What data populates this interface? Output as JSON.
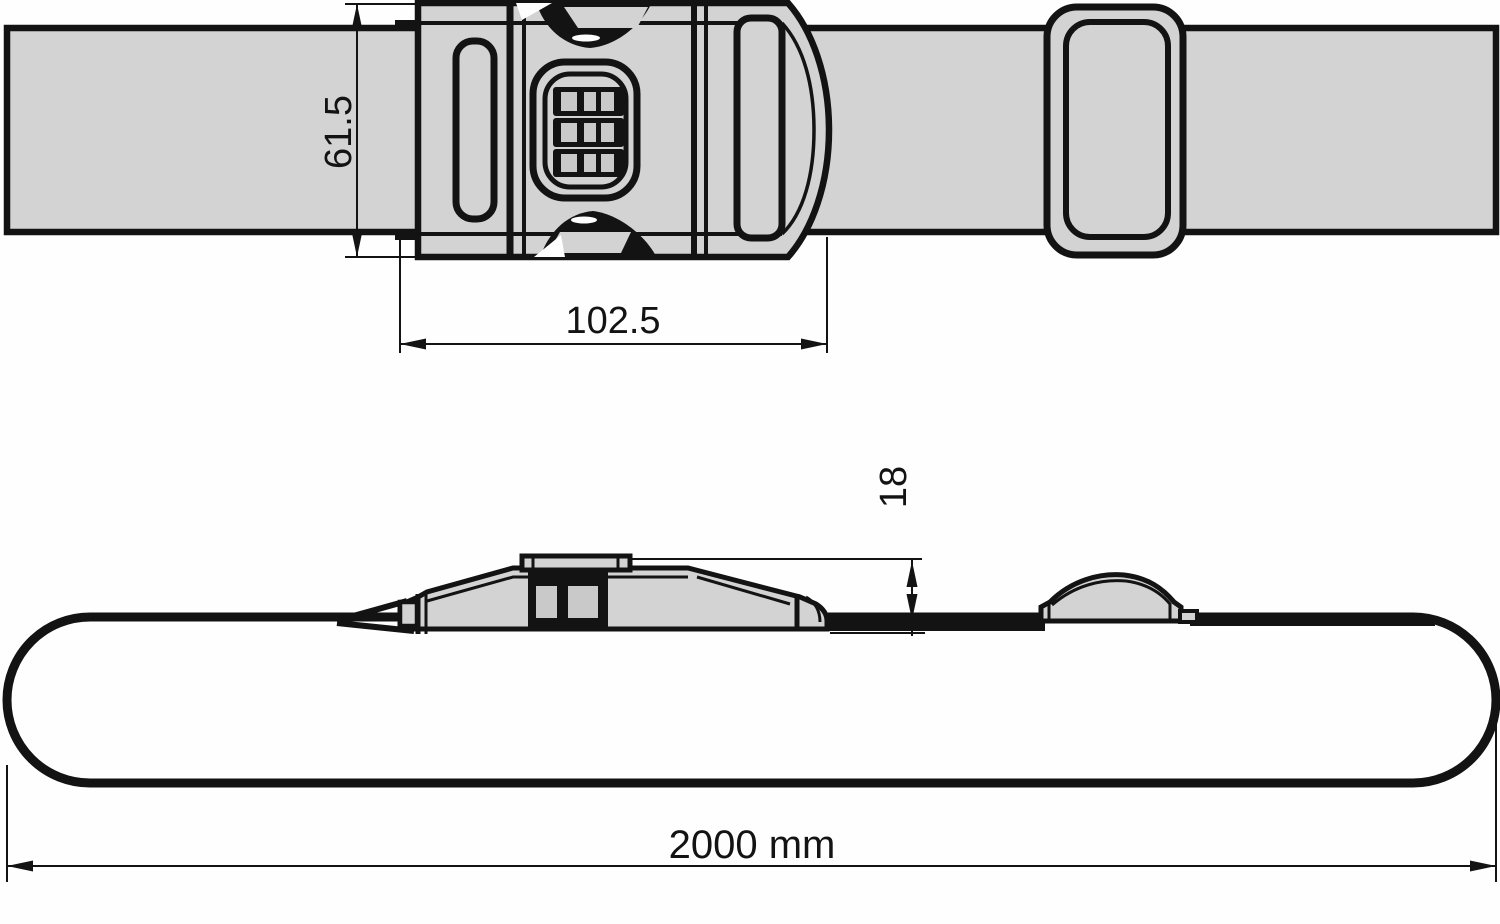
{
  "drawing": {
    "subject": "luggage-strap-with-combination-lock-buckle-technical-drawing",
    "views": [
      "top-view",
      "side-view"
    ],
    "colors": {
      "background": "#fefefe",
      "strap_fill": "#d3d3d3",
      "dial_window_fill": "#c9c9c9",
      "line": "#131313"
    },
    "dimensions": {
      "strap_width_mm": "61.5",
      "buckle_length_mm": "102.5",
      "buckle_height_mm": "18",
      "total_length": "2000 mm"
    }
  }
}
